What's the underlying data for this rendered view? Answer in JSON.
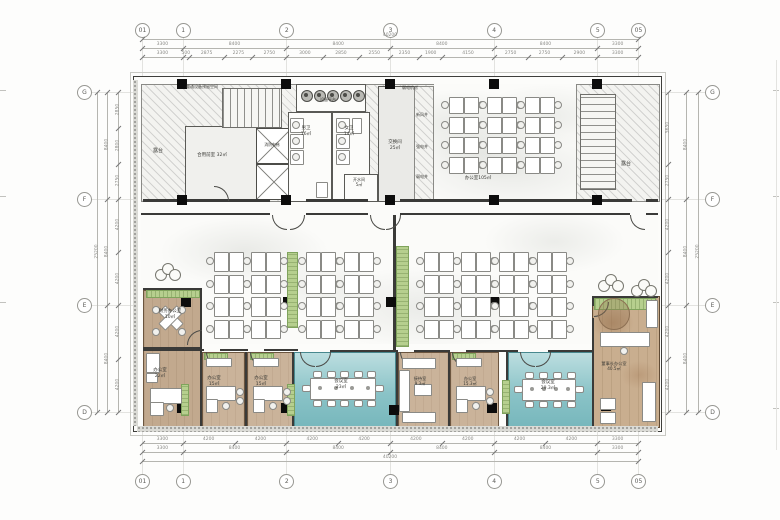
{
  "drawing": {
    "type": "office floor plan"
  },
  "grid": {
    "cols": [
      "01",
      "1",
      "2",
      "3",
      "4",
      "5",
      "05"
    ],
    "rows": [
      "G",
      "F",
      "E",
      "D"
    ]
  },
  "dims": {
    "top": {
      "overall": "40200",
      "grid": [
        "3300",
        "8400",
        "8400",
        "8400",
        "8400",
        "3300"
      ],
      "sub": [
        "3300",
        "500",
        "2875",
        "2275",
        "2750",
        "3000",
        "2850",
        "2550",
        "2350",
        "1900",
        "4150",
        "2750",
        "2750",
        "2900",
        "3300"
      ]
    },
    "bottom": {
      "overall": "40200",
      "grid": [
        "3300",
        "8400",
        "8400",
        "8400",
        "8400",
        "3300"
      ],
      "sub": [
        "3300",
        "4200",
        "4200",
        "4200",
        "4200",
        "4200",
        "4200",
        "4200",
        "4200",
        "3300"
      ]
    },
    "left": {
      "overall": "25200",
      "grid": [
        "8400",
        "8400",
        "8400"
      ],
      "sub": [
        "2850",
        "2800",
        "2750",
        "4200",
        "4200",
        "4200",
        "4200"
      ]
    },
    "right": {
      "overall": "25200",
      "grid": [
        "8400",
        "8400",
        "8400"
      ],
      "sub": [
        "5650",
        "2750",
        "4200",
        "4200",
        "4200",
        "4200"
      ]
    }
  },
  "rooms": [
    {
      "name": "暖通设备预留空间",
      "area": "",
      "label": "暖通设备预留空间"
    },
    {
      "name": "露台",
      "area": "",
      "label": "露台"
    },
    {
      "name": "合用前室",
      "area": "32㎡",
      "label": "合用前室  32㎡"
    },
    {
      "name": "设备平台",
      "area": "",
      "label": "设备平台"
    },
    {
      "name": "男卫",
      "area": "16㎡",
      "label": "男卫\n16㎡"
    },
    {
      "name": "女卫",
      "area": "14㎡",
      "label": "女卫\n14㎡"
    },
    {
      "name": "开水间",
      "area": "5㎡",
      "label": "开水间\n5㎡"
    },
    {
      "name": "交换间",
      "area": "25㎡",
      "label": "交换间\n25㎡"
    },
    {
      "name": "弱电机房",
      "area": "",
      "label": "弱电机房"
    },
    {
      "name": "新风井",
      "area": "",
      "label": "新风井"
    },
    {
      "name": "强电井",
      "area": "",
      "label": "强电井"
    },
    {
      "name": "弱电井",
      "area": "",
      "label": "弱电井"
    },
    {
      "name": "消防电梯",
      "area": "",
      "label": "消防电梯"
    },
    {
      "name": "办公室",
      "area": "105㎡",
      "label": "办公室105㎡"
    },
    {
      "name": "露台",
      "area": "",
      "label": "露台"
    },
    {
      "name": "财务办公室",
      "area": "10㎡",
      "label": "财务办公室\n10㎡"
    },
    {
      "name": "办公室",
      "area": "22㎡",
      "label": "办公室\n22㎡"
    },
    {
      "name": "办公室",
      "area": "15㎡",
      "label": "办公室\n15㎡"
    },
    {
      "name": "办公室",
      "area": "15㎡",
      "label": "办公室\n15㎡"
    },
    {
      "name": "会议室",
      "area": "23㎡",
      "label": "会议室\n23㎡"
    },
    {
      "name": "接待室",
      "area": "9.3㎡",
      "label": "接待室\n9.3㎡"
    },
    {
      "name": "办公室",
      "area": "15.3㎡",
      "label": "办公室\n15.3㎡"
    },
    {
      "name": "会议室",
      "area": "29.3㎡",
      "label": "会议室\n29.3㎡"
    },
    {
      "name": "董事长办公室",
      "area": "40.5㎡",
      "label": "董事长办公室\n40.5㎡"
    }
  ],
  "colors": {
    "wood_floor": "#c2a98e",
    "teal_floor": "#8ac3c7",
    "planter_green": "#b6cf8e",
    "line": "#3a3a38"
  }
}
